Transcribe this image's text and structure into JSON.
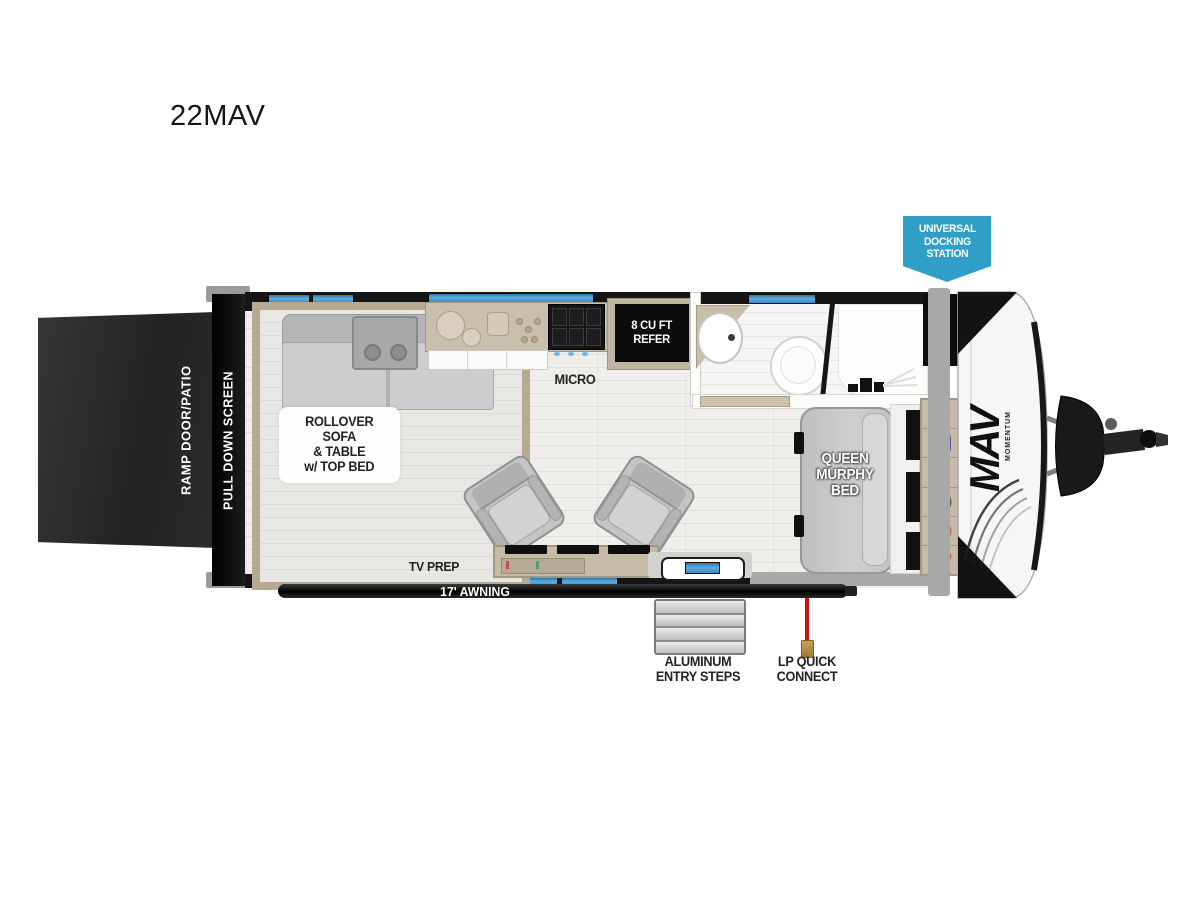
{
  "title": "22MAV",
  "badge": {
    "text": "UNIVERSAL\nDOCKING\nSTATION",
    "color": "#2f9fc8"
  },
  "exterior": {
    "ramp_door": "RAMP DOOR/PATIO",
    "pull_down_screen": "PULL DOWN SCREEN",
    "awning": "17' AWNING",
    "entry_steps": "ALUMINUM\nENTRY STEPS",
    "lp_quick_connect": "LP QUICK\nCONNECT",
    "logo": "MAV",
    "logo_sub": "MOMENTUM"
  },
  "interior": {
    "sofa": "ROLLOVER\nSOFA\n& TABLE\nw/ TOP BED",
    "micro": "MICRO",
    "refrigerator": "8 CU FT\nREFER",
    "murphy_bed": "QUEEN\nMURPHY\nBED",
    "tv_prep": "TV PREP"
  },
  "colors": {
    "window_blue": "#4aa3dc",
    "wall_black": "#151515",
    "cabinet_tan": "#c6bba6",
    "lp_hose_red": "#cc1212"
  }
}
